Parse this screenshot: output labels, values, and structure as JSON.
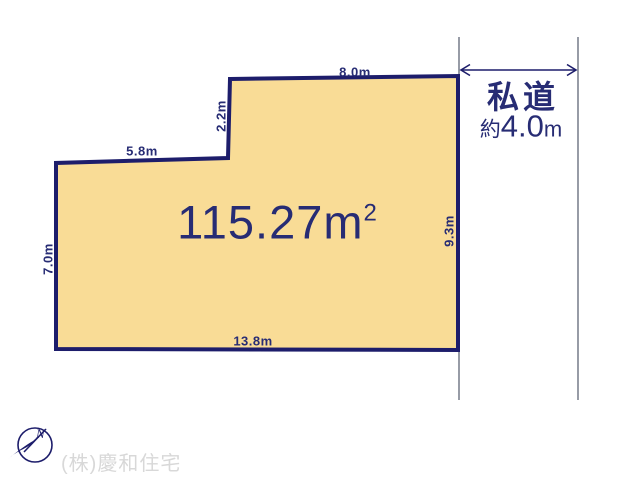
{
  "diagram": {
    "area": {
      "value": "115.27m",
      "sup": "2"
    },
    "dimensions": {
      "top": "8.0m",
      "notch": "2.2m",
      "upper_left": "5.8m",
      "left": "7.0m",
      "right": "9.3m",
      "bottom": "13.8m"
    },
    "road": {
      "name": "私道",
      "width_prefix": "約",
      "width_value": "4.0",
      "width_unit": "m"
    },
    "compass": {
      "north_label": "N"
    },
    "watermark": "(株)慶和住宅"
  },
  "colors": {
    "plot-fill": "#f9dc96",
    "plot-border": "#1d1d6b",
    "label-text": "#272c74",
    "road-line": "#6b7180",
    "watermark-text": "#d8d8d8"
  }
}
